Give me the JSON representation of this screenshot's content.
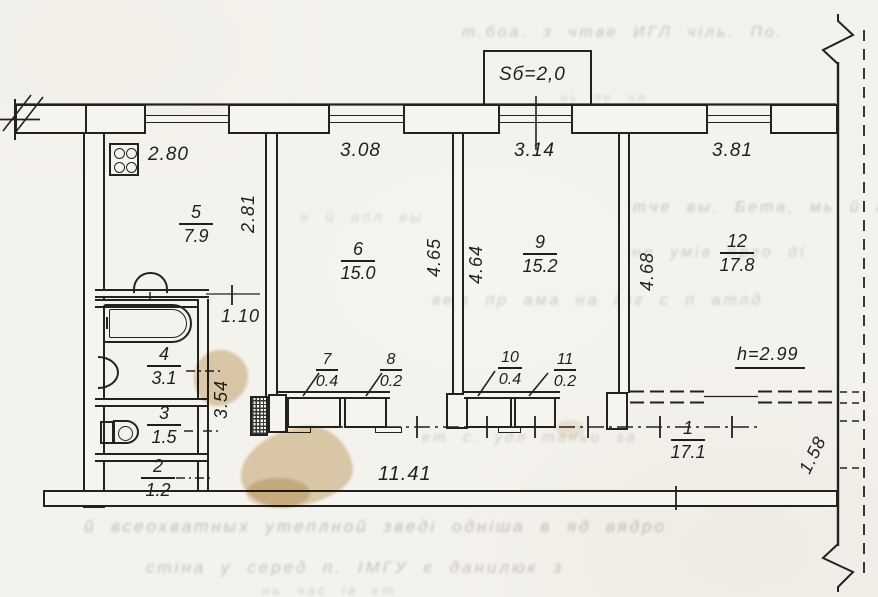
{
  "drawing_type": "apartment floor plan (scanned technical passport sheet)",
  "balcony": {
    "label": "Sб=2,0"
  },
  "height_note": "h=2.99",
  "rooms": {
    "r5": {
      "num": "5",
      "area": "7.9"
    },
    "r6": {
      "num": "6",
      "area": "15.0"
    },
    "r9": {
      "num": "9",
      "area": "15.2"
    },
    "r12": {
      "num": "12",
      "area": "17.8"
    },
    "r4": {
      "num": "4",
      "area": "3.1"
    },
    "r3": {
      "num": "3",
      "area": "1.5"
    },
    "r2": {
      "num": "2",
      "area": "1.2"
    },
    "r7": {
      "num": "7",
      "area": "0.4"
    },
    "r8": {
      "num": "8",
      "area": "0.2"
    },
    "r10": {
      "num": "10",
      "area": "0.4"
    },
    "r11": {
      "num": "11",
      "area": "0.2"
    },
    "r1": {
      "num": "1",
      "area": "17.1"
    }
  },
  "dims": {
    "kitchen_w": "2.80",
    "room6_w": "3.08",
    "room9_w": "3.14",
    "room12_w": "3.81",
    "kitchen_h": "2.81",
    "room6_h": "4.65",
    "room9_h": "4.64",
    "room12_h": "4.68",
    "corridor_w": "1.10",
    "corridor_h": "3.54",
    "total_w": "11.41",
    "hall_right": "1.58"
  },
  "bleed": {
    "b1": "т.боа. з чтве ИГЛ чіль. По.",
    "b2": "нь пе чл",
    "b3": "н й апл вы",
    "b4": "этче вы. Бета, мь й год",
    "b5": "не умів прго ді",
    "b6": "вет пр ама на імг с п атлд",
    "b7": "ет с. удл таньи за",
    "b8": "й всеохватных утеплной зведі одніша в яд вядро",
    "b9": "стіна у серед п. ІМГУ є данилюк з",
    "b10": "нь час ів кт"
  },
  "colors": {
    "ink": "#24221e",
    "paper": "#f4f2ec",
    "stain": "#cbac74"
  }
}
